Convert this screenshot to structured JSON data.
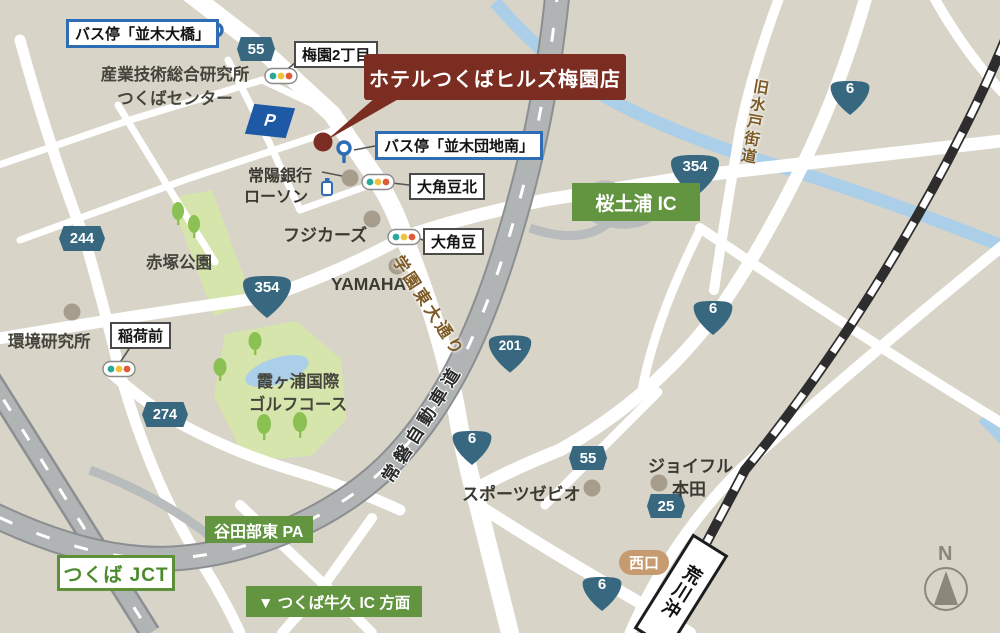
{
  "colors": {
    "background": "#d8d4c8",
    "road": "#ffffff",
    "expressway": "#b1b4b5",
    "railway": "#2d2d2d",
    "river": "#abcfe9",
    "park": "#d6e5ab",
    "hotel_red": "#7c2d22",
    "route_badge_blue": "#38687f",
    "highway_green": "#639540",
    "bus_blue": "#2e6db4",
    "station_exit_tan": "#c79b70",
    "road_name_brown": "#7d5a26"
  },
  "hotel": {
    "name": "ホテルつくばヒルズ梅園店"
  },
  "bus_stops": {
    "namiki_ohashi": "バス停「並木大橋」",
    "namiki_danchi_minami": "バス停「並木団地南」"
  },
  "intersections": {
    "umezono_2chome": "梅園2丁目",
    "sasagi_kita": "大角豆北",
    "sasagi": "大角豆",
    "inarimae": "稲荷前"
  },
  "places": {
    "aist_line1": "産業技術総合研究所",
    "aist_line2": "つくばセンター",
    "joyo_bank": "常陽銀行",
    "lawson": "ローソン",
    "fuji_cars": "フジカーズ",
    "yamaha": "YAMAHA",
    "akatsuka_park": "赤塚公園",
    "env_institute": "環境研究所",
    "golf_line1": "霞ヶ浦国際",
    "golf_line2": "ゴルフコース",
    "sports_xebio": "スポーツゼビオ",
    "joyful_line1": "ジョイフル",
    "joyful_line2": "本田"
  },
  "road_names": {
    "joban_expressway": "常磐自動車道",
    "old_mito_kaido": "旧水戸街道",
    "gakuen_higashi_odori": "学園東大通り"
  },
  "highway_labels": {
    "sakura_tsuchiura_ic": "桜土浦 IC",
    "yatabe_higashi_pa": "谷田部東 PA",
    "tsukuba_jct": "つくば JCT",
    "ushiku_direction": "▼ つくば牛久 IC 方面"
  },
  "station": {
    "name": "荒川沖",
    "west_exit": "西口"
  },
  "route_badges": {
    "hex_55_north": "55",
    "hex_244": "244",
    "hex_274": "274",
    "hex_55_south": "55",
    "hex_25": "25",
    "shield_354_west": "354",
    "shield_354_east": "354",
    "shield_6_ne": "6",
    "shield_6_mid": "6",
    "shield_6_center": "6",
    "shield_6_south": "6",
    "shield_201": "201"
  },
  "parking": {
    "label": "P"
  },
  "compass": {
    "north": "N"
  }
}
